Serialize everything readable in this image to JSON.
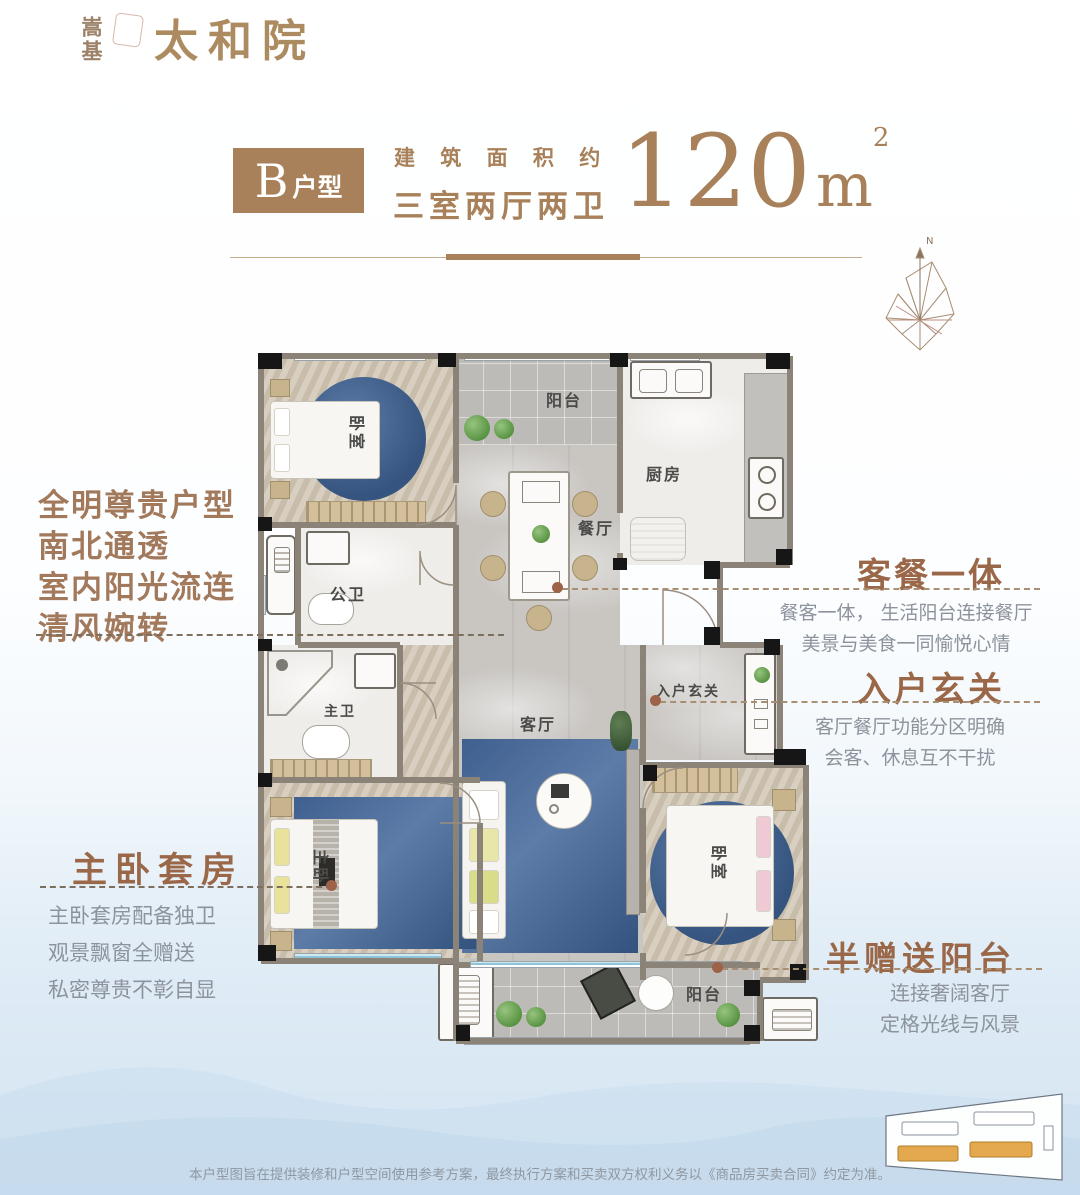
{
  "logo": {
    "vertical_name": "嵩基",
    "project_name": "太和院"
  },
  "title": {
    "badge_letter": "B",
    "badge_suffix": "户型",
    "area_prefix": "建 筑 面 积 约",
    "layout_label": "三室两厅两卫",
    "area_value": "120",
    "area_unit": "m",
    "area_sup": "2"
  },
  "compass": {
    "north_label": "N"
  },
  "features": {
    "left_top": {
      "lines": [
        "全明尊贵户型",
        "南北通透",
        "室内阳光流连",
        "清风婉转"
      ]
    },
    "dining": {
      "title": "客餐一体",
      "desc": [
        "餐客一体， 生活阳台连接餐厅",
        "美景与美食一同愉悦心情"
      ]
    },
    "entry": {
      "title": "入户玄关",
      "desc": [
        "客厅餐厅功能分区明确",
        "会客、休息互不干扰"
      ]
    },
    "master": {
      "title": "主卧套房",
      "desc": [
        "主卧套房配备独卫",
        "观景飘窗全赠送",
        "私密尊贵不彰自显"
      ]
    },
    "balcony": {
      "title": "半赠送阳台",
      "desc": [
        "连接奢阔客厅",
        "定格光线与风景"
      ]
    }
  },
  "rooms": {
    "bedroom_top": "卧室",
    "balcony_top": "阳台",
    "kitchen": "厨房",
    "dining": "餐厅",
    "bath_public": "公卫",
    "bath_master": "主卫",
    "living": "客厅",
    "entry": "入户玄关",
    "master_bedroom": "主卧",
    "bedroom_bottom": "卧室",
    "balcony_bottom": "阳台"
  },
  "disclaimer": "本户型图旨在提供装修和户型空间使用参考方案，最终执行方案和买卖双方权利义务以《商品房买卖合同》约定为准。",
  "colors": {
    "accent_brown": "#a8815a",
    "heading_brown": "#9a6848",
    "calligraphy_brown": "#a3795c",
    "desc_gray": "#8d939c",
    "rug_blue": "#3f5f8f",
    "window_blue": "#8fc3d8",
    "site_building_yellow": "#e4a94f",
    "bg_bottom_blue": "#d3e4f1"
  }
}
